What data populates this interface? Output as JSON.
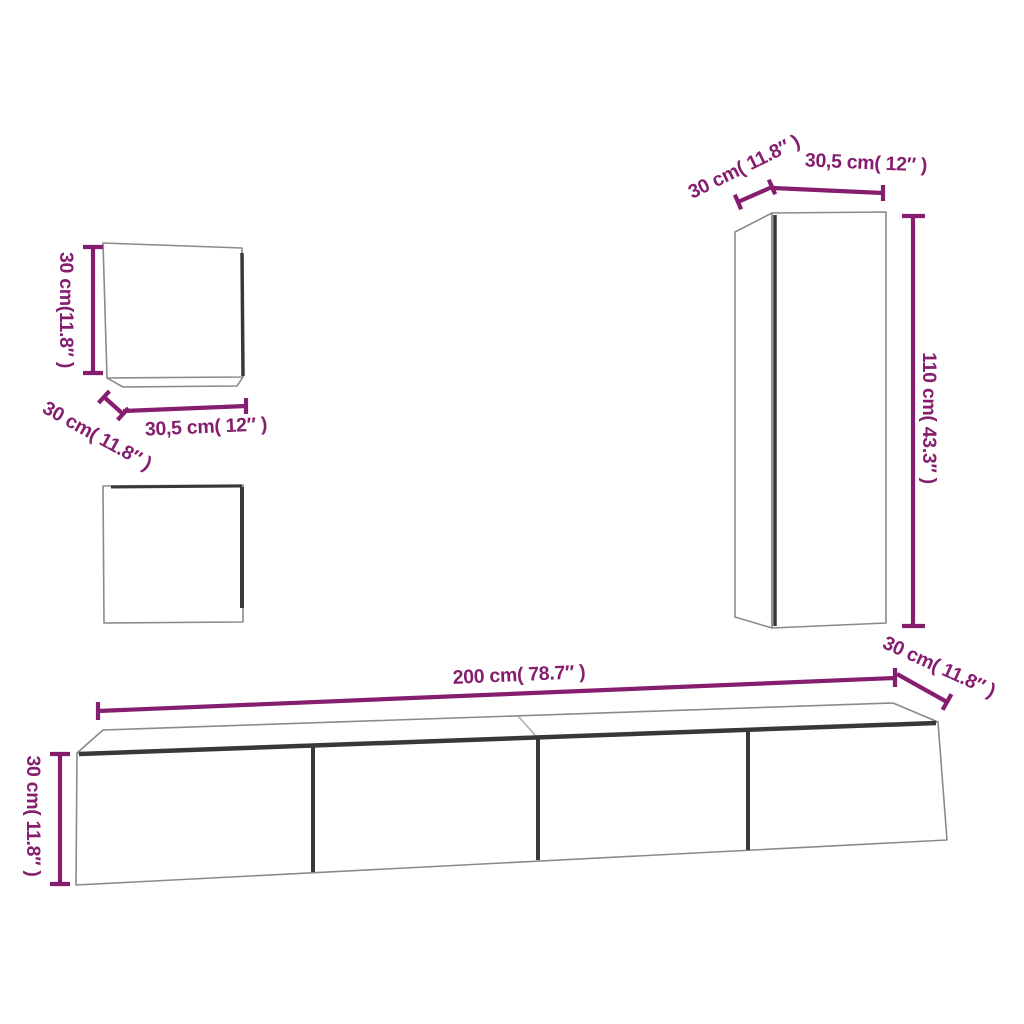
{
  "page": {
    "background_color": "#ffffff",
    "accent_color": "#851e6e",
    "outline_color": "#8a8a8a",
    "shadow_color": "#383838"
  },
  "diagram": {
    "type": "furniture-dimension-drawing",
    "cabinets": {
      "small_wall_cabinet_top": {
        "height_label": "30 cm(11.8″ )",
        "depth_label": "30 cm( 11.8″ )",
        "width_label": "30,5 cm( 12″ )"
      },
      "tall_wall_cabinet": {
        "depth_label": "30 cm( 11.8″ )",
        "width_label": "30,5 cm( 12″ )",
        "height_label": "110 cm( 43.3″ )"
      },
      "tv_bench": {
        "width_label": "200 cm( 78.7″ )",
        "depth_label": "30 cm( 11.8″ )",
        "height_label": "30 cm( 11.8″ )"
      }
    }
  }
}
